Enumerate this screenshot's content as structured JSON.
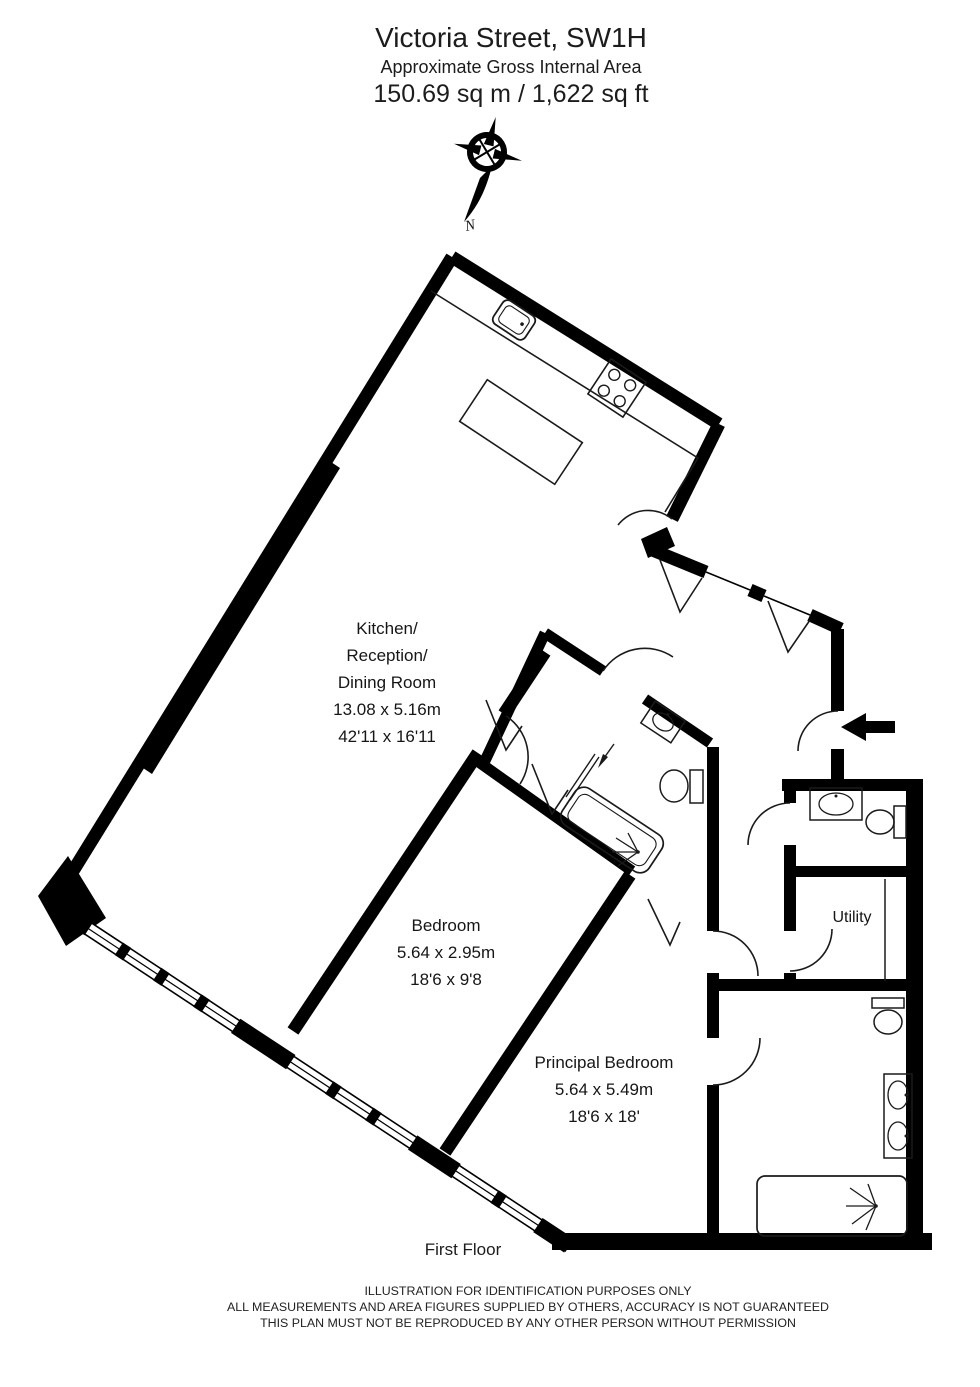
{
  "header": {
    "title": "Victoria Street, SW1H",
    "subtitle": "Approximate Gross Internal Area",
    "area": "150.69 sq m  /  1,622 sq ft"
  },
  "compass": {
    "north_label": "N"
  },
  "rooms": {
    "kitchen": {
      "lines": [
        "Kitchen/",
        "Reception/",
        "Dining Room"
      ],
      "dim_m": "13.08 x 5.16m",
      "dim_ft": "42'11 x 16'11"
    },
    "bedroom": {
      "name": "Bedroom",
      "dim_m": "5.64 x 2.95m",
      "dim_ft": "18'6 x 9'8"
    },
    "principal": {
      "name": "Principal Bedroom",
      "dim_m": "5.64 x 5.49m",
      "dim_ft": "18'6 x 18'"
    },
    "utility": {
      "name": "Utility"
    }
  },
  "floor_label": "First Floor",
  "footer": {
    "lines": [
      "ILLUSTRATION FOR IDENTIFICATION PURPOSES ONLY",
      "ALL MEASUREMENTS AND AREA FIGURES SUPPLIED BY OTHERS, ACCURACY IS NOT GUARANTEED",
      "THIS PLAN MUST NOT BE REPRODUCED BY ANY OTHER PERSON WITHOUT PERMISSION"
    ]
  },
  "colors": {
    "wall": "#000000",
    "line": "#1a1a1a",
    "text": "#1c1c1c"
  }
}
